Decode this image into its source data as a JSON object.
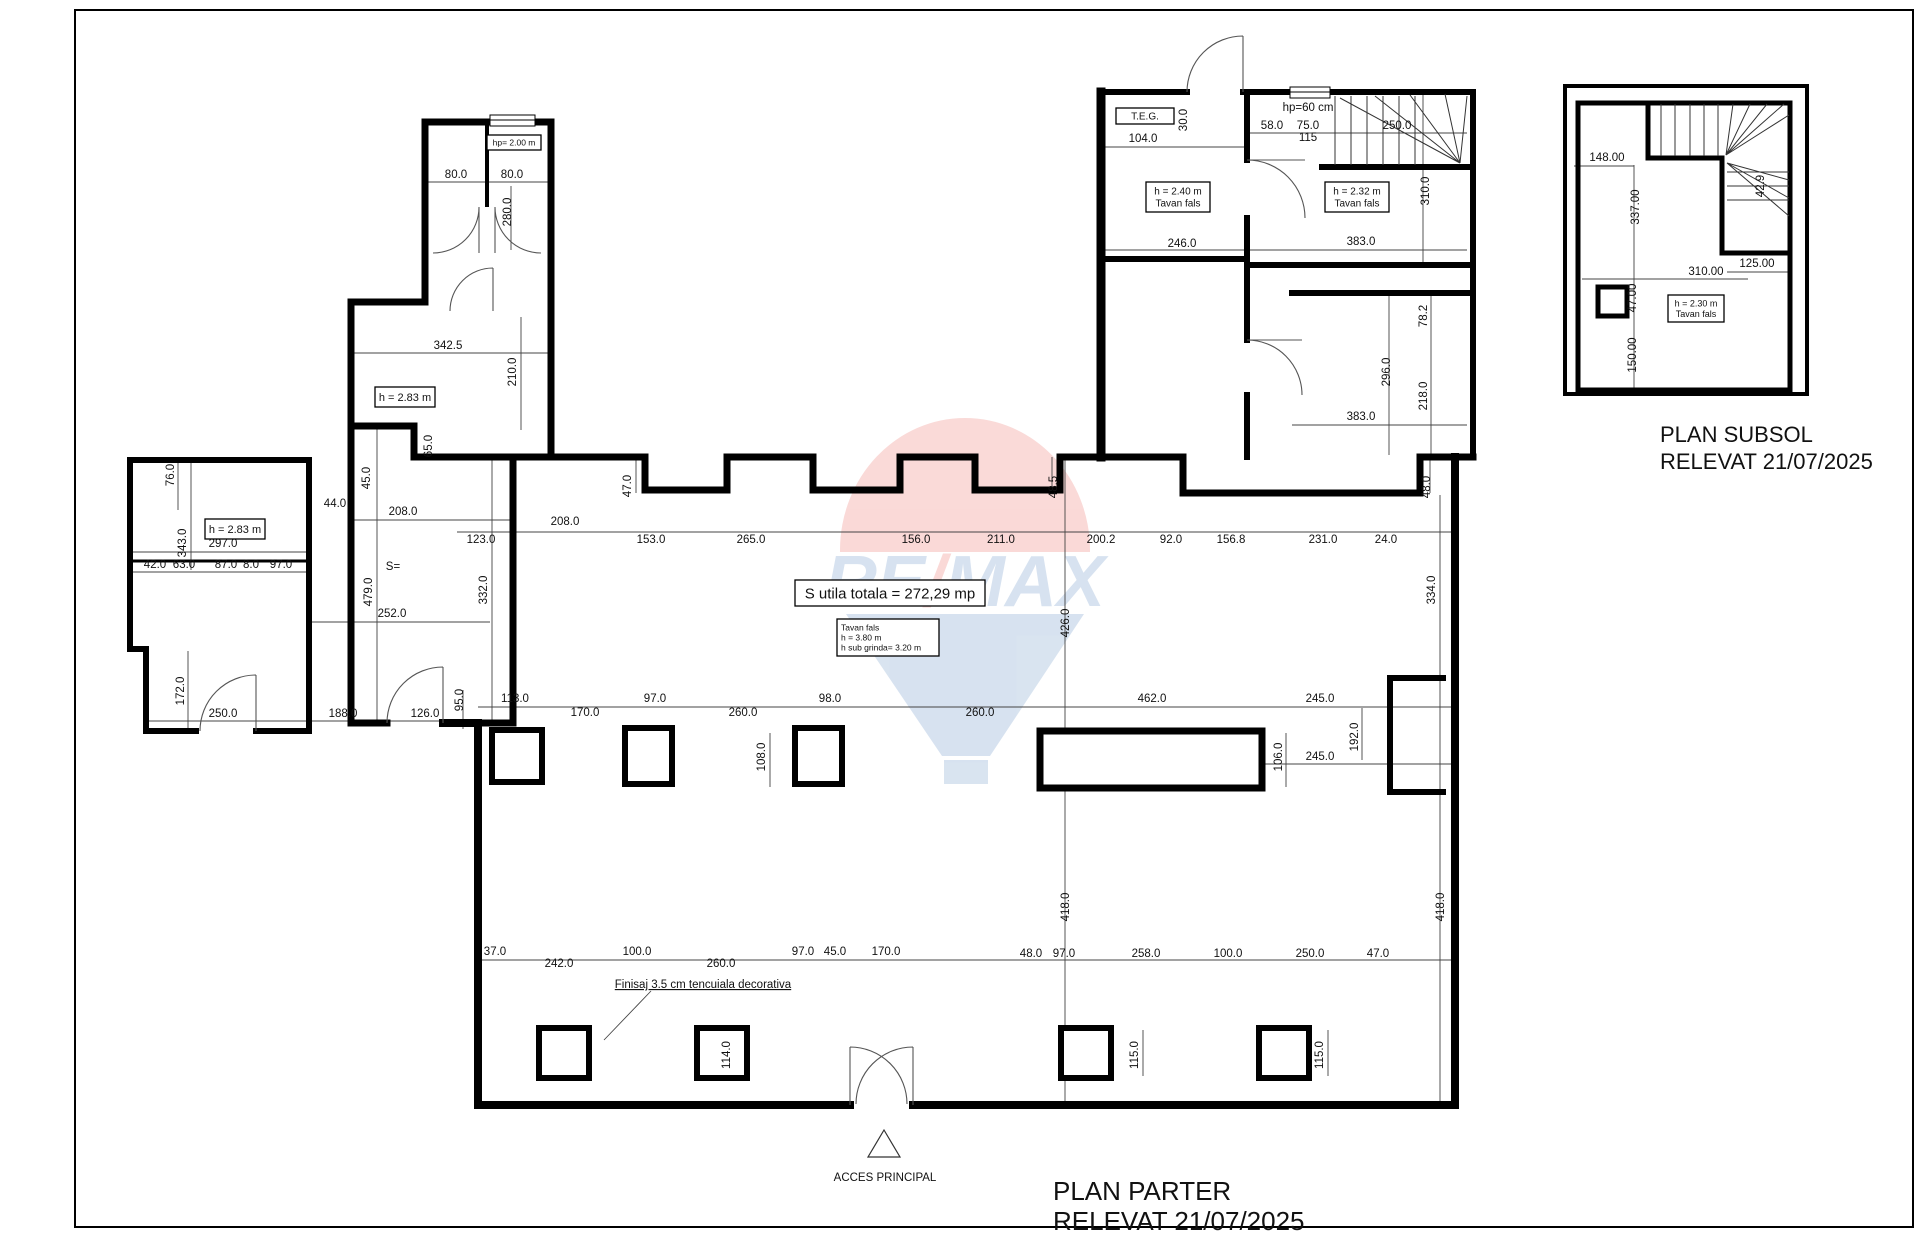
{
  "titles": {
    "parter_line1": "PLAN PARTER",
    "parter_line2": "RELEVAT 21/07/2025",
    "subsol_line1": "PLAN SUBSOL",
    "subsol_line2": "RELEVAT 21/07/2025"
  },
  "annotations": {
    "acces_principal": "ACCES PRINCIPAL",
    "finisaj": "Finisaj 3.5 cm tencuiala decorativa"
  },
  "watermark": {
    "re": "RE",
    "slash": "/",
    "max": "MAX",
    "red": "#e2231a",
    "blue": "#1b5ca8"
  },
  "boxes": [
    {
      "x": 487,
      "y": 135,
      "w": 54,
      "h": 15,
      "fs": 8.5,
      "lines": [
        "hp= 2.00 m"
      ]
    },
    {
      "x": 375,
      "y": 387,
      "w": 60,
      "h": 20,
      "fs": 11,
      "lines": [
        "h = 2.83 m"
      ]
    },
    {
      "x": 205,
      "y": 519,
      "w": 60,
      "h": 20,
      "fs": 11,
      "lines": [
        "h = 2.83 m"
      ]
    },
    {
      "x": 1146,
      "y": 182,
      "w": 64,
      "h": 30,
      "fs": 10,
      "lines": [
        "h = 2.40 m",
        "Tavan fals"
      ]
    },
    {
      "x": 1325,
      "y": 182,
      "w": 64,
      "h": 30,
      "fs": 10,
      "lines": [
        "h = 2.32 m",
        "Tavan fals"
      ]
    },
    {
      "x": 1116,
      "y": 108,
      "w": 58,
      "h": 16,
      "fs": 10,
      "lines": [
        "T.E.G."
      ]
    },
    {
      "x": 795,
      "y": 580,
      "w": 190,
      "h": 26,
      "fs": 15,
      "lines": [
        "S utila totala = 272,29 mp"
      ]
    },
    {
      "x": 837,
      "y": 619,
      "w": 102,
      "h": 37,
      "fs": 8.5,
      "align": "left",
      "lines": [
        "Tavan fals",
        "h = 3.80 m",
        "h sub grinda= 3.20 m"
      ]
    },
    {
      "x": 1668,
      "y": 295,
      "w": 56,
      "h": 27,
      "fs": 9,
      "lines": [
        "h = 2.30 m",
        "Tavan fals"
      ]
    }
  ],
  "dim_labels": [
    {
      "t": "80.0",
      "x": 456,
      "y": 178
    },
    {
      "t": "80.0",
      "x": 512,
      "y": 178
    },
    {
      "t": "280.0",
      "x": 511,
      "y": 212,
      "r": 1
    },
    {
      "t": "342.5",
      "x": 448,
      "y": 349
    },
    {
      "t": "210.0",
      "x": 516,
      "y": 372,
      "r": 1
    },
    {
      "t": "65.0",
      "x": 432,
      "y": 446,
      "r": 1
    },
    {
      "t": "76.0",
      "x": 174,
      "y": 475,
      "r": 1
    },
    {
      "t": "343.0",
      "x": 186,
      "y": 543,
      "r": 1
    },
    {
      "t": "297.0",
      "x": 223,
      "y": 547
    },
    {
      "t": "42.0",
      "x": 155,
      "y": 568,
      "fs": 10
    },
    {
      "t": "63.0",
      "x": 184,
      "y": 568,
      "fs": 10
    },
    {
      "t": "87.0",
      "x": 226,
      "y": 568,
      "fs": 10
    },
    {
      "t": "8.0",
      "x": 251,
      "y": 568,
      "fs": 10
    },
    {
      "t": "97.0",
      "x": 281,
      "y": 568,
      "fs": 10
    },
    {
      "t": "172.0",
      "x": 184,
      "y": 691,
      "r": 1
    },
    {
      "t": "250.0",
      "x": 223,
      "y": 717
    },
    {
      "t": "188.0",
      "x": 343,
      "y": 717
    },
    {
      "t": "126.0",
      "x": 425,
      "y": 717
    },
    {
      "t": "44.0",
      "x": 335,
      "y": 507
    },
    {
      "t": "45.0",
      "x": 370,
      "y": 478,
      "r": 1
    },
    {
      "t": "208.0",
      "x": 403,
      "y": 515
    },
    {
      "t": "S=",
      "x": 393,
      "y": 570,
      "fs": 13
    },
    {
      "t": "479.0",
      "x": 372,
      "y": 592,
      "r": 1
    },
    {
      "t": "252.0",
      "x": 392,
      "y": 617
    },
    {
      "t": "332.0",
      "x": 487,
      "y": 590,
      "r": 1
    },
    {
      "t": "95.0",
      "x": 463,
      "y": 700,
      "r": 1
    },
    {
      "t": "123.0",
      "x": 481,
      "y": 543
    },
    {
      "t": "208.0",
      "x": 565,
      "y": 525
    },
    {
      "t": "153.0",
      "x": 651,
      "y": 543
    },
    {
      "t": "265.0",
      "x": 751,
      "y": 543
    },
    {
      "t": "156.0",
      "x": 916,
      "y": 543
    },
    {
      "t": "211.0",
      "x": 1001,
      "y": 543
    },
    {
      "t": "200.2",
      "x": 1101,
      "y": 543
    },
    {
      "t": "92.0",
      "x": 1171,
      "y": 543
    },
    {
      "t": "156.8",
      "x": 1231,
      "y": 543
    },
    {
      "t": "231.0",
      "x": 1323,
      "y": 543
    },
    {
      "t": "24.0",
      "x": 1386,
      "y": 543
    },
    {
      "t": "47.0",
      "x": 631,
      "y": 486,
      "r": 1
    },
    {
      "t": "48.5",
      "x": 1057,
      "y": 487,
      "r": 1
    },
    {
      "t": "48.0",
      "x": 1430,
      "y": 487,
      "r": 1
    },
    {
      "t": "426.0",
      "x": 1069,
      "y": 623,
      "r": 1
    },
    {
      "t": "334.0",
      "x": 1435,
      "y": 590,
      "r": 1
    },
    {
      "t": "113.0",
      "x": 515,
      "y": 702
    },
    {
      "t": "170.0",
      "x": 585,
      "y": 716
    },
    {
      "t": "97.0",
      "x": 655,
      "y": 702
    },
    {
      "t": "260.0",
      "x": 743,
      "y": 716
    },
    {
      "t": "98.0",
      "x": 830,
      "y": 702
    },
    {
      "t": "260.0",
      "x": 980,
      "y": 716
    },
    {
      "t": "462.0",
      "x": 1152,
      "y": 702
    },
    {
      "t": "245.0",
      "x": 1320,
      "y": 702
    },
    {
      "t": "108.0",
      "x": 765,
      "y": 757,
      "r": 1
    },
    {
      "t": "106.0",
      "x": 1282,
      "y": 757,
      "r": 1
    },
    {
      "t": "245.0",
      "x": 1320,
      "y": 760
    },
    {
      "t": "192.0",
      "x": 1358,
      "y": 737,
      "r": 1
    },
    {
      "t": "418.0",
      "x": 1069,
      "y": 907,
      "r": 1
    },
    {
      "t": "418.0",
      "x": 1444,
      "y": 907,
      "r": 1
    },
    {
      "t": "37.0",
      "x": 495,
      "y": 955
    },
    {
      "t": "242.0",
      "x": 559,
      "y": 967
    },
    {
      "t": "100.0",
      "x": 637,
      "y": 955
    },
    {
      "t": "260.0",
      "x": 721,
      "y": 967
    },
    {
      "t": "97.0",
      "x": 803,
      "y": 955
    },
    {
      "t": "45.0",
      "x": 835,
      "y": 955
    },
    {
      "t": "170.0",
      "x": 886,
      "y": 955
    },
    {
      "t": "48.0",
      "x": 1031,
      "y": 957
    },
    {
      "t": "97.0",
      "x": 1064,
      "y": 957
    },
    {
      "t": "258.0",
      "x": 1146,
      "y": 957
    },
    {
      "t": "100.0",
      "x": 1228,
      "y": 957
    },
    {
      "t": "250.0",
      "x": 1310,
      "y": 957
    },
    {
      "t": "47.0",
      "x": 1378,
      "y": 957
    },
    {
      "t": "114.0",
      "x": 730,
      "y": 1055,
      "r": 1
    },
    {
      "t": "115.0",
      "x": 1138,
      "y": 1055,
      "r": 1
    },
    {
      "t": "115.0",
      "x": 1323,
      "y": 1055,
      "r": 1
    },
    {
      "t": "104.0",
      "x": 1143,
      "y": 142
    },
    {
      "t": "30.0",
      "x": 1187,
      "y": 120,
      "r": 1,
      "fs": 10
    },
    {
      "t": "hp=60 cm",
      "x": 1308,
      "y": 111,
      "fs": 9
    },
    {
      "t": "58.0",
      "x": 1272,
      "y": 129
    },
    {
      "t": "75.0",
      "x": 1308,
      "y": 129
    },
    {
      "t": "115",
      "x": 1308,
      "y": 141,
      "fs": 9
    },
    {
      "t": "250.0",
      "x": 1397,
      "y": 129
    },
    {
      "t": "310.0",
      "x": 1429,
      "y": 191,
      "r": 1
    },
    {
      "t": "246.0",
      "x": 1182,
      "y": 247
    },
    {
      "t": "383.0",
      "x": 1361,
      "y": 245
    },
    {
      "t": "78.2",
      "x": 1427,
      "y": 316,
      "r": 1
    },
    {
      "t": "296.0",
      "x": 1390,
      "y": 372,
      "r": 1
    },
    {
      "t": "218.0",
      "x": 1427,
      "y": 396,
      "r": 1
    },
    {
      "t": "383.0",
      "x": 1361,
      "y": 420
    },
    {
      "t": "148.00",
      "x": 1607,
      "y": 161,
      "fs": 9
    },
    {
      "t": "337.00",
      "x": 1639,
      "y": 207,
      "r": 1,
      "fs": 9
    },
    {
      "t": "310.00",
      "x": 1706,
      "y": 275,
      "fs": 9
    },
    {
      "t": "125.00",
      "x": 1757,
      "y": 267,
      "fs": 9
    },
    {
      "t": "47.00",
      "x": 1636,
      "y": 298,
      "r": 1,
      "fs": 9
    },
    {
      "t": "150.00",
      "x": 1636,
      "y": 355,
      "r": 1,
      "fs": 9
    },
    {
      "t": "42.9",
      "x": 1764,
      "y": 186,
      "r": 1,
      "fs": 7
    }
  ]
}
